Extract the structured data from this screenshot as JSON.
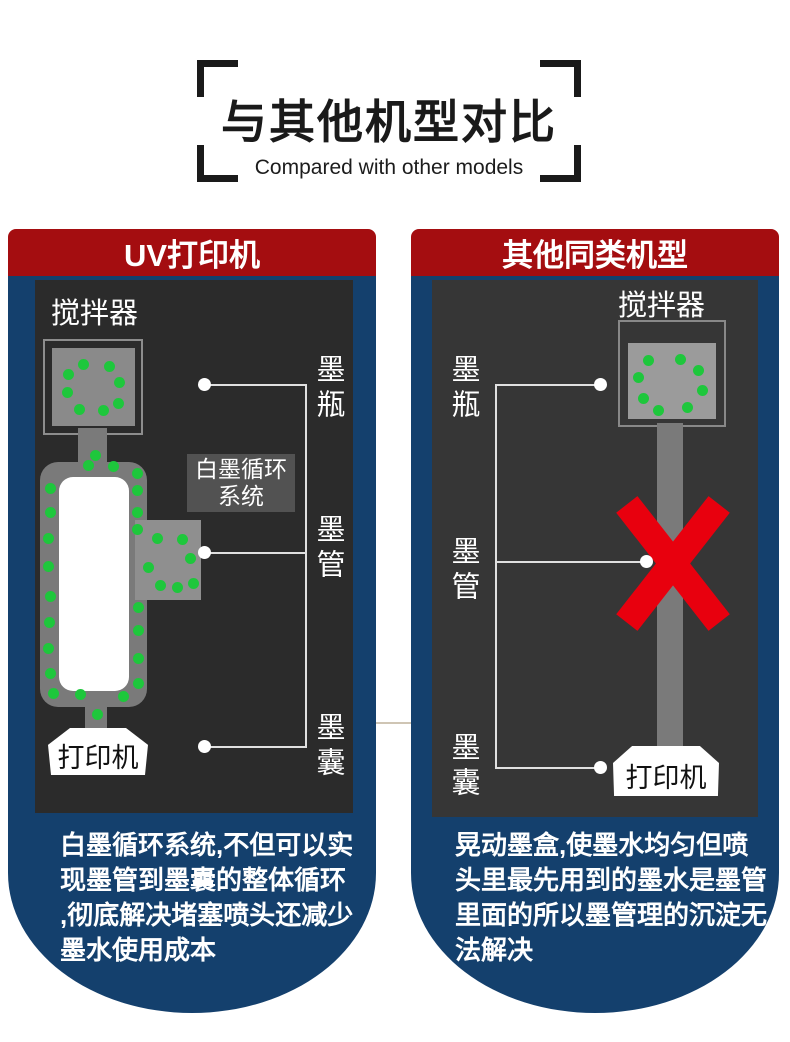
{
  "title": {
    "zh": "与其他机型对比",
    "en": "Compared with other models"
  },
  "colors": {
    "header_red": "#a40d10",
    "panel_navy": "#14406d",
    "diagram_bg_left": "#2b2b2b",
    "diagram_bg_right": "#363636",
    "ink_green": "#1ec73c",
    "x_red": "#e8000e"
  },
  "left_panel": {
    "header": "UV打印机",
    "labels": {
      "stirrer": "搅拌器",
      "ink_bottle": "墨瓶",
      "ink_tube": "墨管",
      "ink_sac": "墨囊",
      "printer": "打印机",
      "system_box": "白墨循环\n系统"
    },
    "description": "白墨循环系统,不但可以实\n现墨管到墨囊的整体循环\n,彻底解决堵塞喷头还减少\n墨水使用成本"
  },
  "right_panel": {
    "header": "其他同类机型",
    "labels": {
      "stirrer": "搅拌器",
      "ink_bottle": "墨瓶",
      "ink_tube": "墨管",
      "ink_sac": "墨囊",
      "printer": "打印机"
    },
    "description": "晃动墨盒,使墨水均匀但喷\n头里最先用到的墨水是墨管\n里面的所以墨管理的沉淀无\n法解决"
  }
}
